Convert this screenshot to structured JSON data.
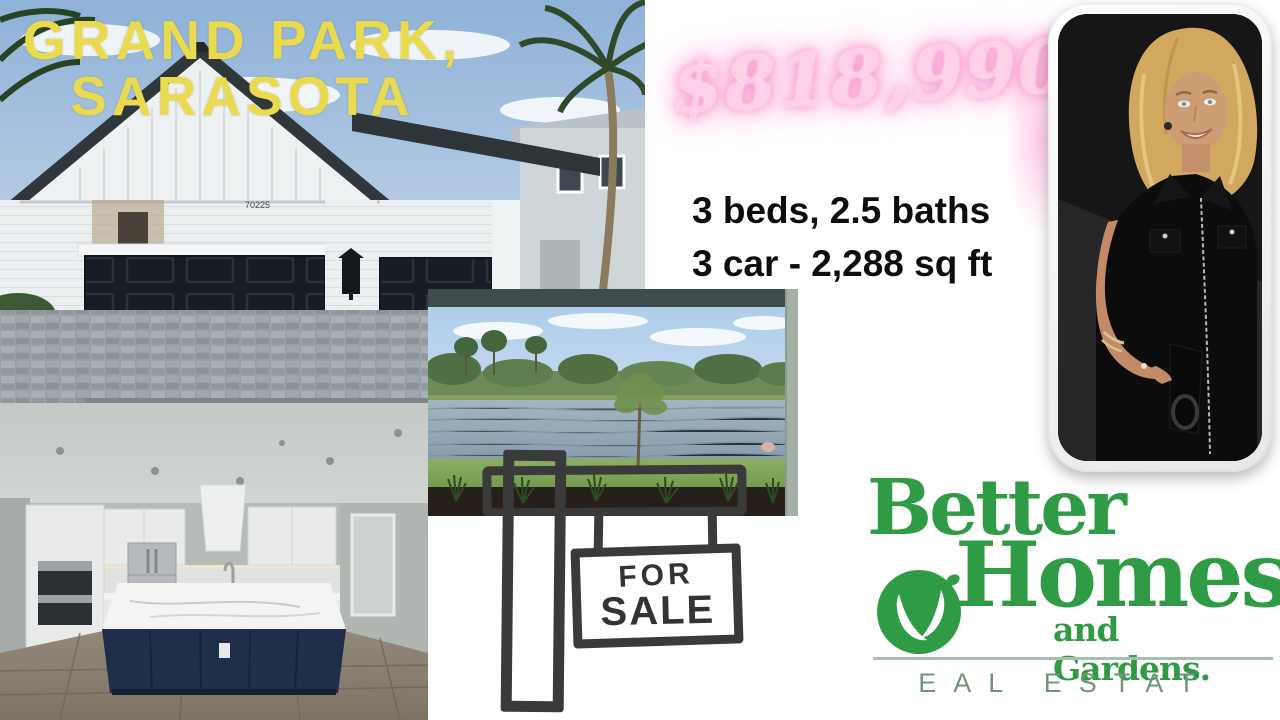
{
  "colors": {
    "title-yellow": "#e9da50",
    "price-pink": "#ffd0e8",
    "price-glow": "#f78fc9",
    "specs-black": "#0d0d0d",
    "brand-green": "#2f9b45",
    "brand-muted": "#72937d",
    "sketch-ink": "#3a3a3a"
  },
  "title": {
    "line1": "GRAND PARK,",
    "line2": "SARASOTA"
  },
  "price": {
    "value": "$818,990"
  },
  "specs": {
    "line1": "3 beds, 2.5 baths",
    "line2": "3 car - 2,288 sq ft"
  },
  "house_photo": {
    "house_number": "70225"
  },
  "sale_sign": {
    "line1": "FOR",
    "line2": "SALE"
  },
  "brand": {
    "word1": "Better",
    "word2": "Homes",
    "word3": "and Gardens.",
    "tagline": "EAL ESTAT"
  }
}
